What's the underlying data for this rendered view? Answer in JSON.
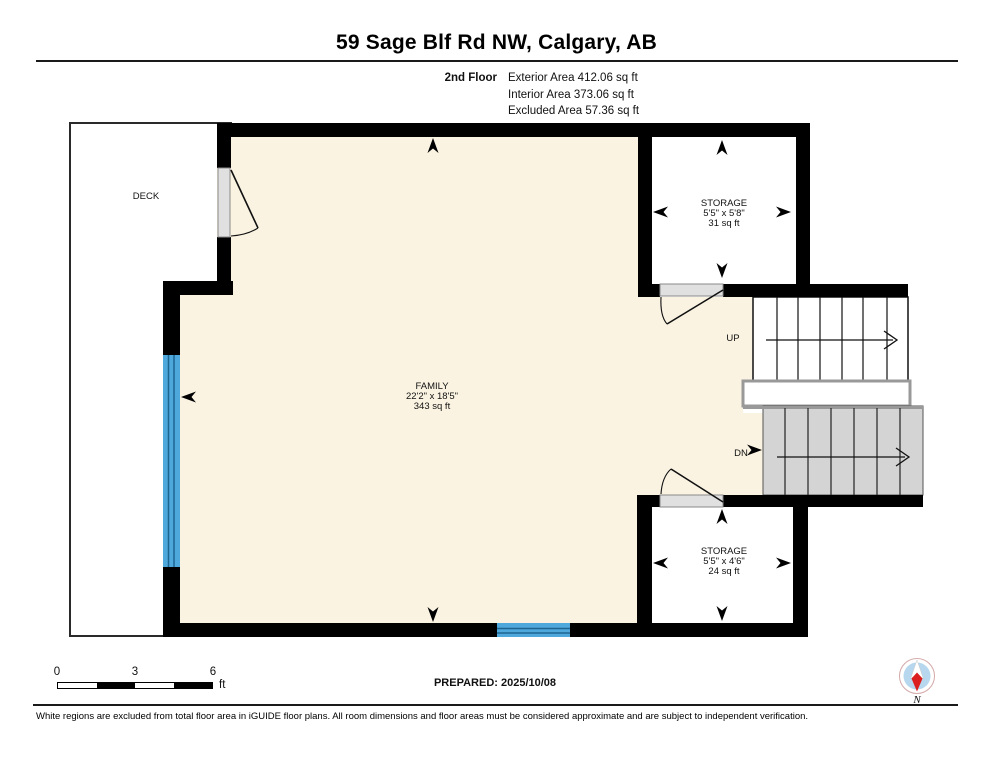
{
  "header": {
    "title": "59 Sage Blf Rd NW, Calgary, AB",
    "floor_label": "2nd Floor",
    "area_lines": [
      "Exterior Area 412.06 sq ft",
      "Interior Area 373.06 sq ft",
      "Excluded Area 57.36 sq ft"
    ]
  },
  "rooms": {
    "deck": {
      "name": "DECK"
    },
    "family": {
      "name": "FAMILY",
      "dims": "22'2\" x 18'5\"",
      "area": "343 sq ft"
    },
    "storage_top": {
      "name": "STORAGE",
      "dims": "5'5\" x 5'8\"",
      "area": "31 sq ft"
    },
    "storage_bottom": {
      "name": "STORAGE",
      "dims": "5'5\" x 4'6\"",
      "area": "24 sq ft"
    }
  },
  "stairs": {
    "up_label": "UP",
    "dn_label": "DN"
  },
  "footer": {
    "scale": {
      "ticks": [
        "0",
        "3",
        "6"
      ],
      "unit": "ft"
    },
    "prepared": "PREPARED: 2025/10/08",
    "compass_label": "N",
    "disclaimer": "White regions are excluded from total floor area in iGUIDE floor plans. All room dimensions and floor areas must be considered approximate and are subject to independent verification."
  },
  "colors": {
    "floor_fill": "#faf3e2",
    "window_blue": "#4fa8db",
    "window_line_blue": "#1d6591",
    "stair_gray": "#d4d4d4",
    "railing_gray": "#999999",
    "door_gray": "#e0e0e0",
    "wall_black": "#000000",
    "compass_blue": "#b7d7ee",
    "compass_red": "#db1f1f"
  }
}
